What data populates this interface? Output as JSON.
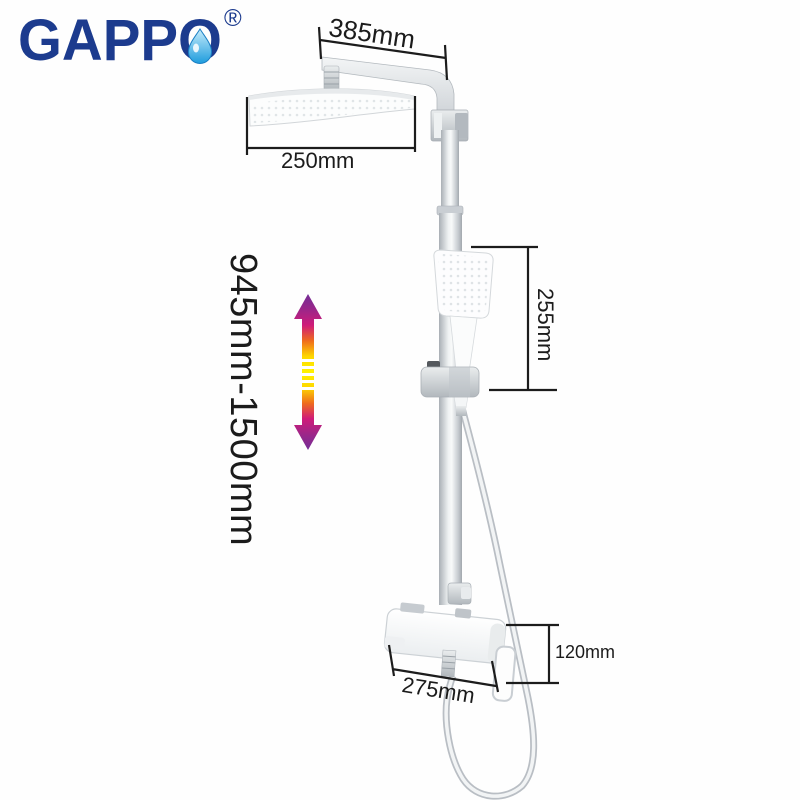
{
  "logo": {
    "brand": "GAPPO",
    "registered_mark": "®"
  },
  "annotations": {
    "arm_length": "385mm",
    "head_width": "250mm",
    "hand_shower_section_height": "255mm",
    "column_height_range": "945mm-1500mm",
    "mixer_section_height": "120mm",
    "mixer_width": "275mm"
  },
  "icons": {
    "water_drop": "water-drop",
    "height_range_arrow": "vertical-double-arrow-gradient"
  },
  "colors": {
    "background": "#ffffff",
    "brand_blue": "#1c3b8e",
    "drop_blue_light": "#c8ecfb",
    "drop_blue_dark": "#1e9cdd",
    "dimension_ink": "#1c1c1c",
    "chrome_light": "#f4f6f7",
    "chrome_mid": "#c7ccd1",
    "chrome_dark": "#9aa1a7",
    "arrow_purple": "#732d96",
    "arrow_magenta": "#cf1b79",
    "arrow_orange": "#ef6c1c",
    "arrow_yellow": "#fff200"
  }
}
